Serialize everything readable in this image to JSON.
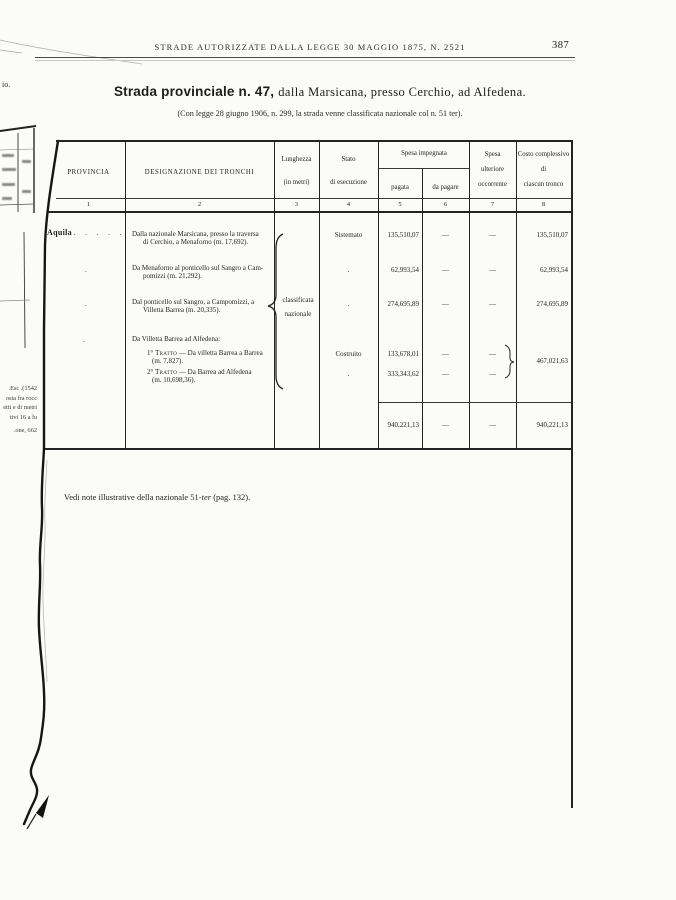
{
  "page": {
    "running_header": "STRADE AUTORIZZATE DALLA LEGGE 30 MAGGIO 1875, N. 2521",
    "page_number": "387",
    "title": {
      "bold": "Strada provinciale n. 47,",
      "rest": "dalla Marsicana, presso Cerchio, ad Alfedena."
    },
    "subtitle": "(Con legge 28 giugno 1906, n. 299, la strada venne classificata nazionale col n. 51 ter).",
    "footnote": {
      "pre": "Vedi note illustrative della nazionale 51-",
      "italic": "ter",
      "post": " (pag. 132)."
    }
  },
  "table": {
    "headers": {
      "col1": "PROVINCIA",
      "col2": "DESIGNAZIONE DEI TRONCHI",
      "col3a": "Lunghezza",
      "col3b": "(in metri)",
      "col4a": "Stato",
      "col4b": "di esecuzione",
      "group56": "Spesa impegnata",
      "col5": "pagata",
      "col6": "da pagare",
      "col7a": "Spesa",
      "col7b": "ulteriore",
      "col7c": "occorrente",
      "col8a": "Costo complessivo",
      "col8b": "di",
      "col8c": "ciascun tronco",
      "numbers": [
        "1",
        "2",
        "3",
        "4",
        "5",
        "6",
        "7",
        "8"
      ]
    },
    "classification_note": {
      "line1": "classificata",
      "line2": "nazionale"
    },
    "province": "Aquila",
    "province_dots": ". . . . .",
    "ditto": ".",
    "rows": [
      {
        "desc1": "Dalla nazionale Marsicana, presso la traversa",
        "desc2": "di Cerchio, a Menaforno (m. 17,692).",
        "stato": "Sistemato",
        "pagata": "135,510,07",
        "da_pagare": "—",
        "ulteriore": "—",
        "costo": "135,510,07"
      },
      {
        "desc1": "Da Menaforno al ponticello sul Sangro a Cam-",
        "desc2": "pomizzi (m. 21,292).",
        "stato": ".",
        "pagata": "62,993,54",
        "da_pagare": "—",
        "ulteriore": "—",
        "costo": "62,993,54"
      },
      {
        "desc1": "Dal ponticello sul Sangro, a Campomizzi, a",
        "desc2": "Villetta Barrea (m. 20,335).",
        "stato": ".",
        "pagata": "274,695,89",
        "da_pagare": "—",
        "ulteriore": "—",
        "costo": "274,695,89"
      },
      {
        "heading": "Da Villetta Barrea ad Alfedena:"
      },
      {
        "num": "1°",
        "label": "Tratto",
        "desc1": "— Da villetta Barrea a Barrea",
        "desc2": "(m. 7,827).",
        "stato": "Costruito",
        "pagata": "133,678,01",
        "da_pagare": "—",
        "ulteriore": "—"
      },
      {
        "num": "2°",
        "label": "Tratto",
        "desc1": "— Da Barrea ad Alfedena",
        "desc2": "(m. 10,698,36).",
        "stato": ".",
        "pagata": "333,343,62",
        "da_pagare": "—",
        "ulteriore": "—"
      }
    ],
    "combined_costo": "467,021,63",
    "totals": {
      "pagata": "940,221,13",
      "da_pagare": "—",
      "ulteriore": "—",
      "costo": "940,221,13"
    }
  },
  "margin": {
    "top_fragment": "io.",
    "fragments": [
      "1542). Esc.",
      "osta fra rocc",
      "etti e di metri",
      "tivi 16 a lu",
      "one, 662."
    ]
  }
}
